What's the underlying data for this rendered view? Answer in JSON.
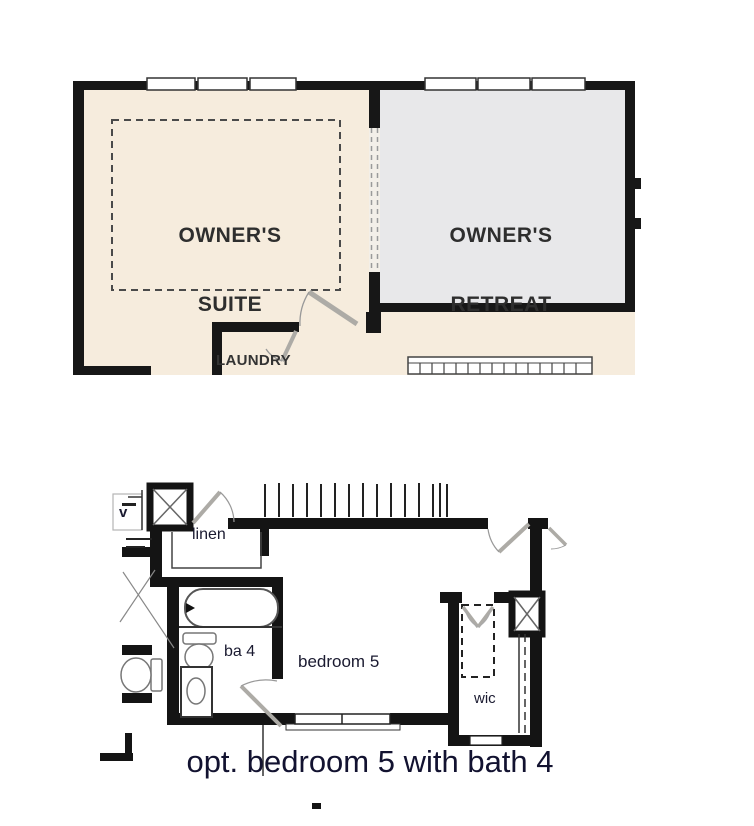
{
  "document": {
    "type": "floor-plan-sheet",
    "background": "#ffffff"
  },
  "upper_plan": {
    "description": "owner's suite / owner's retreat partial plan",
    "floor_color": "#f6ecdd",
    "retreat_floor_color": "#e8e8ea",
    "wall_color": "#171717",
    "labels": {
      "owners_suite_line1": "OWNER'S",
      "owners_suite_line2": "SUITE",
      "owners_retreat_line1": "OWNER'S",
      "owners_retreat_line2": "RETREAT",
      "laundry": "LAUNDRY"
    },
    "features": {
      "suite_top_windows": 3,
      "retreat_top_windows": 3,
      "optional_dashed_area": true,
      "stair_rail": true
    }
  },
  "lower_plan": {
    "description": "optional bedroom 5 with bath 4 plan",
    "line_color": "#141414",
    "labels": {
      "linen": "linen",
      "vent": "v",
      "bath4": "ba 4",
      "bedroom5": "bedroom 5",
      "wic": "wic"
    },
    "caption": "opt. bedroom 5 with bath 4",
    "features": {
      "tub": true,
      "toilets": 2,
      "sink": true,
      "chase_boxes": 2,
      "double_doors_wic": true,
      "bottom_window": true,
      "deck_rail_hatch": true
    }
  },
  "colors": {
    "door_leaf": "#adaba6",
    "arc": "#999999",
    "dashed": "#4a4a4a",
    "fixture_stroke": "#777777",
    "text_dark": "#2e2e2e",
    "text_navy": "#1a1a30",
    "caption_color": "#121230"
  }
}
